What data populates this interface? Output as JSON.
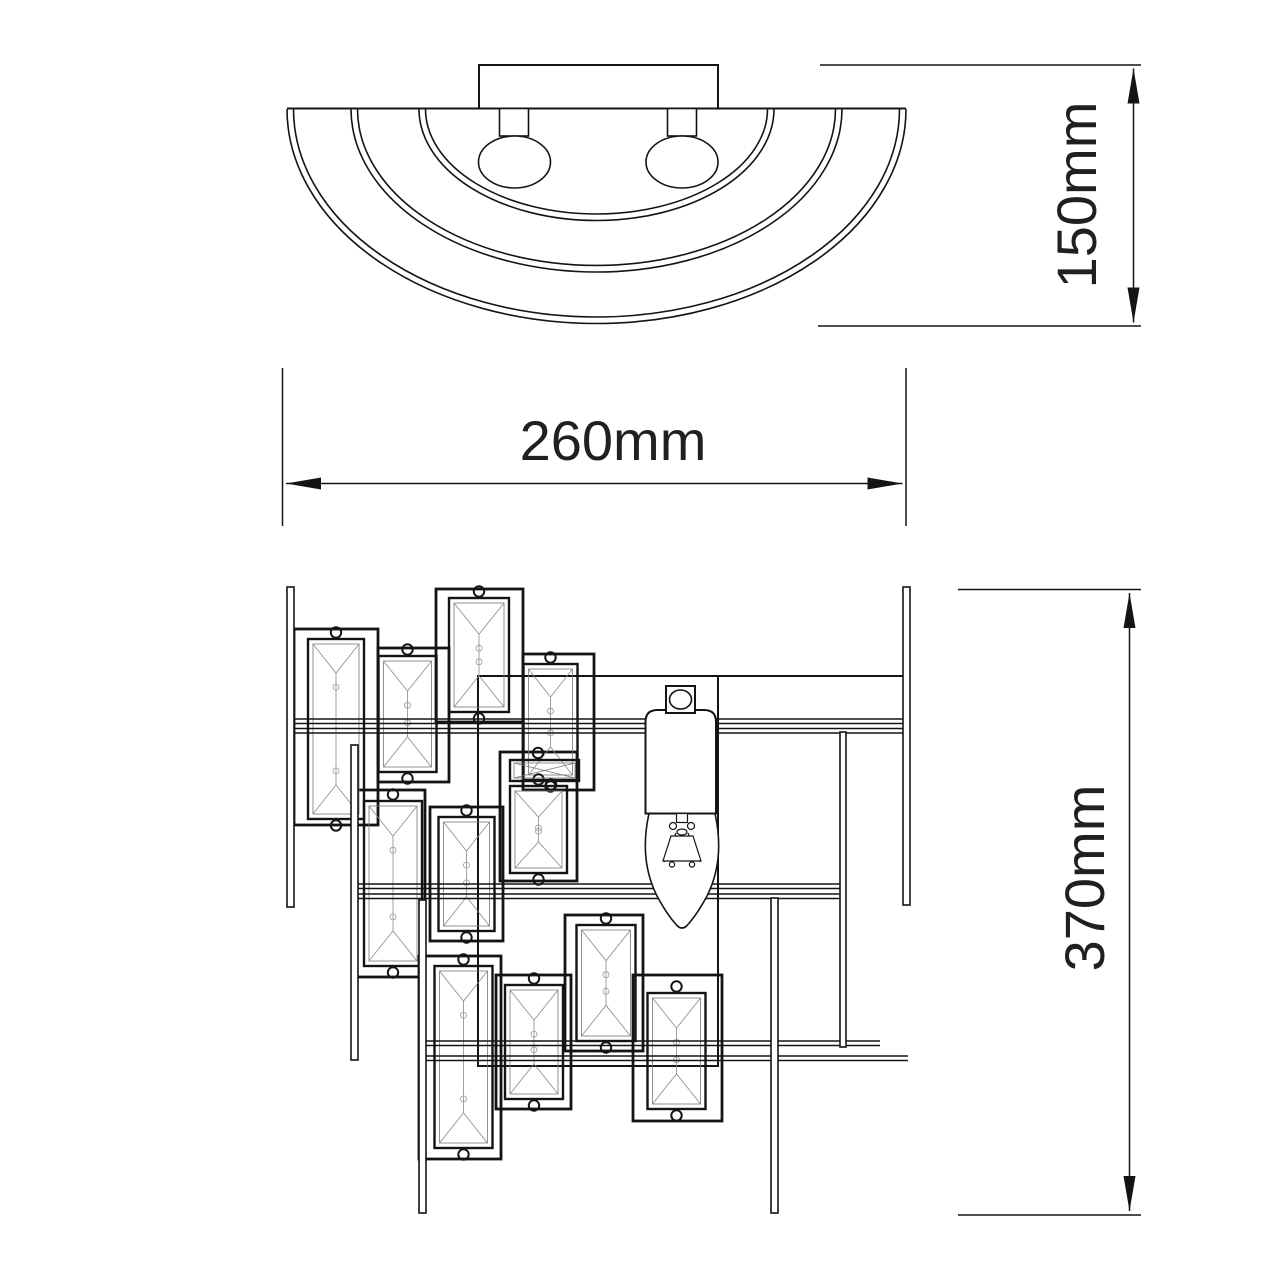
{
  "dimensions": {
    "width_label": "260mm",
    "height_label": "150mm",
    "drop_label": "370mm"
  },
  "colors": {
    "line": "#141414",
    "text": "#231f20",
    "background": "#ffffff"
  }
}
